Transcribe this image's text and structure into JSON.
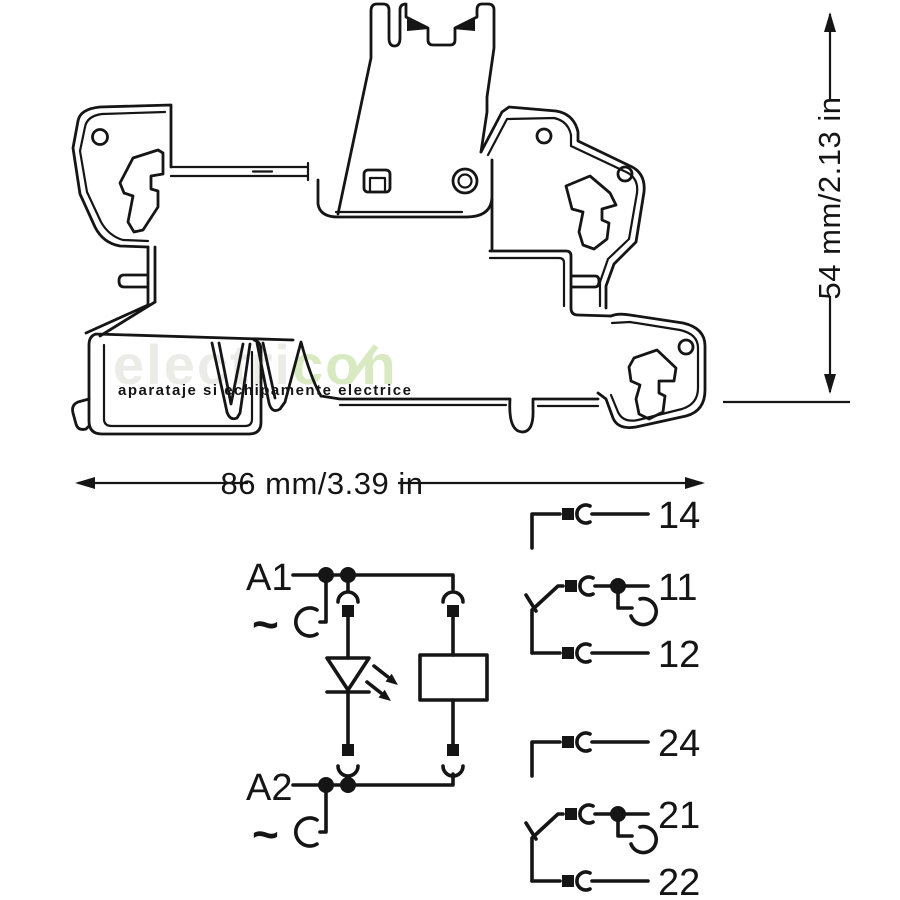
{
  "watermark": {
    "light_text": "electri",
    "green_text": "con",
    "tagline": "aparataje si echipamente electrice",
    "light_color": "#ebece7",
    "green_color": "#d9e9c2",
    "tagline_color": "#cfe3ab"
  },
  "dimensions": {
    "width_label": "86 mm/3.39 in",
    "height_label": "54 mm/2.13 in"
  },
  "schematic": {
    "coil": {
      "a1_label": "A1",
      "a1_symbol": "~",
      "a2_label": "A2",
      "a2_symbol": "~"
    },
    "contact_groups": [
      {
        "terminals": [
          "14",
          "11",
          "12"
        ]
      },
      {
        "terminals": [
          "24",
          "21",
          "22"
        ]
      }
    ]
  },
  "colors": {
    "line": "#151515",
    "background": "#ffffff"
  }
}
